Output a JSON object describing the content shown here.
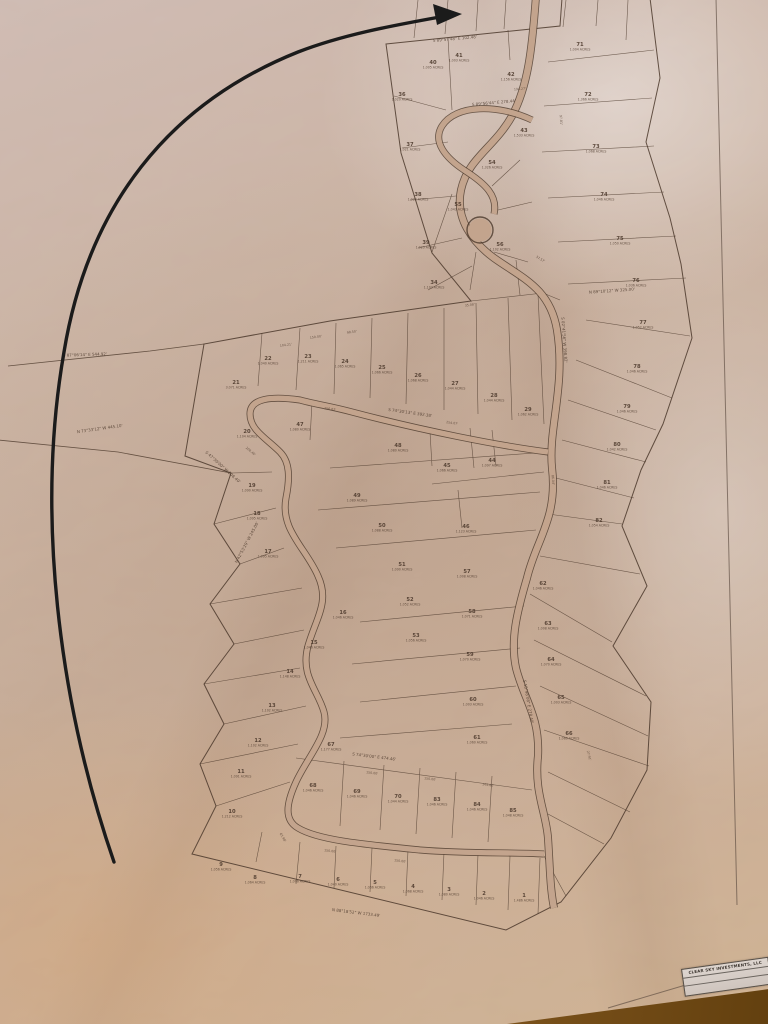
{
  "scene": {
    "description": "Photograph of a wrinkled paper subdivision plat map lying on a wooden table, with a long hand-drawn black arrow curving from the bottom left up to a lot near the top of the plat",
    "colors": {
      "paper": "#c3a48d",
      "ink": "#4b382b",
      "arrow": "#1b1b1b",
      "wood": "#8a5d22",
      "sheet_edge": "#5a4a3f",
      "title_block_bg": "#d6cdc6"
    }
  },
  "title_block": {
    "owner": "CLEAR SKY INVESTMENTS, LLC"
  },
  "map": {
    "boundary": "M386,44 L560,26 L562,-2 L650,-2 L660,78 L646,142 L670,218 L681,264 L692,338 L663,424 L641,470 L622,526 L647,586 L613,646 L651,702 L647,770 L611,838 L561,902 L506,930 L192,854 L216,806 L200,764 L224,724 L204,684 L234,644 L210,604 L240,564 L214,524 L231,473 L185,456 L204,344 L330,321 L471,301 L432,253 L401,153 Z",
    "tie_lines": "M204,344 L150,351 L8,366 M231,473 L118,452 L-2,440",
    "sheet_border": "M716,-2 L737,905 M608,1008 L770,960",
    "lot_lines": "M418,0 L414,38 M448,0 L445,34 M478,0 L476,31 M506,0 L504,29 M566,0 L563,27 M598,0 L596,26 M628,0 L626,40 M394,96 L446,110 M402,148 L448,142 M410,200 L456,196 M418,248 L462,238 M428,290 L472,266 M452,110 L448,38 M510,60 L508,30 M492,186 L520,160 M498,210 L532,202 M494,252 L528,262 M476,252 L470,290 M452,194 L432,252 M471,301 L543,293 M520,295 L516,260 M543,293 L560,300 M548,62 L654,50 M544,106 L652,98 M542,152 L654,146 M548,198 L664,192 M558,242 L676,236 M568,284 L686,278 M586,320 L690,336 M576,360 L672,398 M568,400 L656,430 M562,440 L646,462 M556,478 L634,498 M548,514 L622,524 M540,556 L640,574 M530,594 L612,642 M534,640 L646,696 M540,686 L648,736 M544,730 L649,766 M548,772 L630,812 M548,814 L604,844 M544,856 L566,896 M262,333 L258,386 M300,328 L296,390 M336,323 L334,394 M372,318 L370,398 M408,313 L406,404 M444,308 L444,410 M476,303 L478,414 M508,298 L512,420 M538,294 L544,424 M231,473 L272,472 M214,524 L276,508 M240,564 L284,548 M210,604 L302,588 M234,644 L304,630 M204,684 L300,668 M224,724 L306,706 M200,764 L298,744 M216,806 L290,782 M296,758 L532,790 M344,761 L340,826 M384,765 L380,830 M420,768 L416,834 M456,772 L452,838 M492,776 L488,842 M262,832 L256,862 M300,842 L296,884 M336,846 L334,888 M372,848 L370,892 M408,850 L406,896 M444,852 L442,900 M478,854 L476,905 M510,856 L508,910 M540,858 L538,914 M330,468 L548,452 M318,510 L540,492 M336,548 L536,530 M360,622 L524,606 M352,664 L520,648 M360,702 L516,686 M340,738 L512,724 M470,428 L474,468 M492,430 L496,466 M458,490 L462,528 M430,432 L432,466 M432,484 L544,472 M312,402 L310,440",
    "roads": [
      {
        "d": "M536,-4 C532,50 528,86 512,116 C494,148 468,158 461,190 C455,218 472,242 494,258 C522,278 550,288 557,330 C566,386 548,428 552,468 C558,518 536,540 527,578 C517,612 510,640 516,668 C524,700 540,716 538,756 C534,792 546,812 548,838 C550,868 550,888 554,908",
        "w": 8
      },
      {
        "d": "M548,452 C500,446 420,430 352,412 C330,406 314,404 300,400 C272,396 250,398 250,414 C250,430 266,438 280,452 C290,462 290,478 286,498 C280,530 306,548 318,576 C330,602 316,618 308,646 C300,676 318,690 324,712 C330,734 308,756 296,782 C286,804 284,820 298,828 C318,840 360,844 420,850 C470,854 510,852 544,854",
        "w": 7
      },
      {
        "d": "M532,120 C498,104 456,104 442,126 C432,142 446,158 464,170 C486,184 498,196 494,214",
        "w": 7
      }
    ],
    "culdesac": {
      "cx": 480,
      "cy": 230,
      "r": 13
    },
    "lots": [
      {
        "n": "40",
        "ac": "1.005 ACRES",
        "x": 433,
        "y": 64
      },
      {
        "n": "41",
        "ac": "1.003 ACRES",
        "x": 459,
        "y": 57
      },
      {
        "n": "42",
        "ac": "1.156 ACRES",
        "x": 511,
        "y": 76
      },
      {
        "n": "43",
        "ac": "1.533 ACRES",
        "x": 524,
        "y": 132
      },
      {
        "n": "36",
        "ac": "1.020 ACRES",
        "x": 402,
        "y": 96
      },
      {
        "n": "37",
        "ac": "1.021 ACRES",
        "x": 410,
        "y": 146
      },
      {
        "n": "38",
        "ac": "1.022 ACRES",
        "x": 418,
        "y": 196
      },
      {
        "n": "39",
        "ac": "1.023 ACRES",
        "x": 426,
        "y": 244
      },
      {
        "n": "34",
        "ac": "1.103 ACRES",
        "x": 434,
        "y": 284
      },
      {
        "n": "54",
        "ac": "1.326 ACRES",
        "x": 492,
        "y": 164
      },
      {
        "n": "55",
        "ac": "1.043 ACRES",
        "x": 458,
        "y": 206
      },
      {
        "n": "56",
        "ac": "1.102 ACRES",
        "x": 500,
        "y": 246
      },
      {
        "n": "71",
        "ac": "1.004 ACRES",
        "x": 580,
        "y": 46
      },
      {
        "n": "72",
        "ac": "1.366 ACRES",
        "x": 588,
        "y": 96
      },
      {
        "n": "73",
        "ac": "1.068 ACRES",
        "x": 596,
        "y": 148
      },
      {
        "n": "74",
        "ac": "1.046 ACRES",
        "x": 604,
        "y": 196
      },
      {
        "n": "75",
        "ac": "1.050 ACRES",
        "x": 620,
        "y": 240
      },
      {
        "n": "76",
        "ac": "1.036 ACRES",
        "x": 636,
        "y": 282
      },
      {
        "n": "77",
        "ac": "1.052 ACRES",
        "x": 643,
        "y": 324
      },
      {
        "n": "78",
        "ac": "1.046 ACRES",
        "x": 637,
        "y": 368
      },
      {
        "n": "79",
        "ac": "1.046 ACRES",
        "x": 627,
        "y": 408
      },
      {
        "n": "80",
        "ac": "1.042 ACRES",
        "x": 617,
        "y": 446
      },
      {
        "n": "81",
        "ac": "1.046 ACRES",
        "x": 607,
        "y": 484
      },
      {
        "n": "82",
        "ac": "1.054 ACRES",
        "x": 599,
        "y": 522
      },
      {
        "n": "21",
        "ac": "3.071 ACRES",
        "x": 236,
        "y": 384
      },
      {
        "n": "22",
        "ac": "1.040 ACRES",
        "x": 268,
        "y": 360
      },
      {
        "n": "23",
        "ac": "1.211 ACRES",
        "x": 308,
        "y": 358
      },
      {
        "n": "24",
        "ac": "1.065 ACRES",
        "x": 345,
        "y": 363
      },
      {
        "n": "25",
        "ac": "1.066 ACRES",
        "x": 382,
        "y": 369
      },
      {
        "n": "26",
        "ac": "1.068 ACRES",
        "x": 418,
        "y": 377
      },
      {
        "n": "27",
        "ac": "1.044 ACRES",
        "x": 455,
        "y": 385
      },
      {
        "n": "28",
        "ac": "1.044 ACRES",
        "x": 494,
        "y": 397
      },
      {
        "n": "29",
        "ac": "1.062 ACRES",
        "x": 528,
        "y": 411
      },
      {
        "n": "20",
        "ac": "1.104 ACRES",
        "x": 247,
        "y": 433
      },
      {
        "n": "19",
        "ac": "1.090 ACRES",
        "x": 252,
        "y": 487
      },
      {
        "n": "18",
        "ac": "1.095 ACRES",
        "x": 257,
        "y": 515
      },
      {
        "n": "17",
        "ac": "1.095 ACRES",
        "x": 268,
        "y": 553
      },
      {
        "n": "16",
        "ac": "1.046 ACRES",
        "x": 343,
        "y": 614
      },
      {
        "n": "15",
        "ac": "1.046 ACRES",
        "x": 314,
        "y": 644
      },
      {
        "n": "14",
        "ac": "1.148 ACRES",
        "x": 290,
        "y": 673
      },
      {
        "n": "13",
        "ac": "1.102 ACRES",
        "x": 272,
        "y": 707
      },
      {
        "n": "12",
        "ac": "1.102 ACRES",
        "x": 258,
        "y": 742
      },
      {
        "n": "11",
        "ac": "1.091 ACRES",
        "x": 241,
        "y": 773
      },
      {
        "n": "10",
        "ac": "1.212 ACRES",
        "x": 232,
        "y": 813
      },
      {
        "n": "47",
        "ac": "1.080 ACRES",
        "x": 300,
        "y": 426
      },
      {
        "n": "44",
        "ac": "1.097 ACRES",
        "x": 492,
        "y": 462
      },
      {
        "n": "45",
        "ac": "1.066 ACRES",
        "x": 447,
        "y": 467
      },
      {
        "n": "46",
        "ac": "1.123 ACRES",
        "x": 466,
        "y": 528
      },
      {
        "n": "48",
        "ac": "1.080 ACRES",
        "x": 398,
        "y": 447
      },
      {
        "n": "49",
        "ac": "1.089 ACRES",
        "x": 357,
        "y": 497
      },
      {
        "n": "50",
        "ac": "1.088 ACRES",
        "x": 382,
        "y": 527
      },
      {
        "n": "51",
        "ac": "1.090 ACRES",
        "x": 402,
        "y": 566
      },
      {
        "n": "52",
        "ac": "1.052 ACRES",
        "x": 410,
        "y": 601
      },
      {
        "n": "53",
        "ac": "1.056 ACRES",
        "x": 416,
        "y": 637
      },
      {
        "n": "57",
        "ac": "1.008 ACRES",
        "x": 467,
        "y": 573
      },
      {
        "n": "58",
        "ac": "1.071 ACRES",
        "x": 472,
        "y": 613
      },
      {
        "n": "59",
        "ac": "1.070 ACRES",
        "x": 470,
        "y": 656
      },
      {
        "n": "60",
        "ac": "1.003 ACRES",
        "x": 473,
        "y": 701
      },
      {
        "n": "61",
        "ac": "1.060 ACRES",
        "x": 477,
        "y": 739
      },
      {
        "n": "62",
        "ac": "1.046 ACRES",
        "x": 543,
        "y": 585
      },
      {
        "n": "63",
        "ac": "1.008 ACRES",
        "x": 548,
        "y": 625
      },
      {
        "n": "64",
        "ac": "1.070 ACRES",
        "x": 551,
        "y": 661
      },
      {
        "n": "65",
        "ac": "1.003 ACRES",
        "x": 561,
        "y": 699
      },
      {
        "n": "66",
        "ac": "1.060 ACRES",
        "x": 569,
        "y": 735
      },
      {
        "n": "67",
        "ac": "1.177 ACRES",
        "x": 331,
        "y": 746
      },
      {
        "n": "68",
        "ac": "1.046 ACRES",
        "x": 313,
        "y": 787
      },
      {
        "n": "69",
        "ac": "1.046 ACRES",
        "x": 357,
        "y": 793
      },
      {
        "n": "70",
        "ac": "1.044 ACRES",
        "x": 398,
        "y": 798
      },
      {
        "n": "83",
        "ac": "1.046 ACRES",
        "x": 437,
        "y": 801
      },
      {
        "n": "84",
        "ac": "1.046 ACRES",
        "x": 477,
        "y": 806
      },
      {
        "n": "85",
        "ac": "1.048 ACRES",
        "x": 513,
        "y": 812
      },
      {
        "n": "9",
        "ac": "1.056 ACRES",
        "x": 221,
        "y": 866
      },
      {
        "n": "8",
        "ac": "1.064 ACRES",
        "x": 255,
        "y": 879
      },
      {
        "n": "7",
        "ac": "1.066 ACRES",
        "x": 300,
        "y": 878
      },
      {
        "n": "6",
        "ac": "1.040 ACRES",
        "x": 338,
        "y": 881
      },
      {
        "n": "5",
        "ac": "1.066 ACRES",
        "x": 375,
        "y": 884
      },
      {
        "n": "4",
        "ac": "1.068 ACRES",
        "x": 413,
        "y": 888
      },
      {
        "n": "3",
        "ac": "1.080 ACRES",
        "x": 449,
        "y": 891
      },
      {
        "n": "2",
        "ac": "1.046 ACRES",
        "x": 484,
        "y": 895
      },
      {
        "n": "1",
        "ac": "1.486 ACRES",
        "x": 524,
        "y": 897
      }
    ],
    "bearings": [
      {
        "t": "S 87°06'14\" E  544.92'",
        "x": 85,
        "y": 356,
        "r": -2
      },
      {
        "t": "N 73°33'12\" W  445.10'",
        "x": 100,
        "y": 430,
        "r": -8
      },
      {
        "t": "S 89°57'48\" E  102.48'",
        "x": 455,
        "y": 40,
        "r": -5
      },
      {
        "t": "S 89°56'44\" E  278.44'",
        "x": 494,
        "y": 104,
        "r": -5
      },
      {
        "t": "S 74°30'13\" E  392.38'",
        "x": 410,
        "y": 414,
        "r": 8
      },
      {
        "t": "S 74°30'00\" E  474.46'",
        "x": 374,
        "y": 758,
        "r": 7
      },
      {
        "t": "N 88°18'52\" W  1733.49'",
        "x": 356,
        "y": 914,
        "r": 7
      },
      {
        "t": "N 42°53'29\" W  245.00'",
        "x": 248,
        "y": 543,
        "r": -62
      },
      {
        "t": "S 47°30'00\" W  208.40'",
        "x": 222,
        "y": 468,
        "r": 42
      },
      {
        "t": "S 02°41'56\" W  398.82'",
        "x": 563,
        "y": 340,
        "r": 86
      },
      {
        "t": "S 15°48'08\" E  278.40'",
        "x": 527,
        "y": 702,
        "r": 80
      },
      {
        "t": "N 89°10'12\" W  325.00'",
        "x": 612,
        "y": 292,
        "r": -4
      }
    ],
    "dims": [
      {
        "t": "150.00'",
        "x": 316,
        "y": 338,
        "r": -8
      },
      {
        "t": "104.21'",
        "x": 286,
        "y": 346,
        "r": -8
      },
      {
        "t": "98.50'",
        "x": 352,
        "y": 333,
        "r": -8
      },
      {
        "t": "35.08'",
        "x": 470,
        "y": 306,
        "r": -8
      },
      {
        "t": "194.27'",
        "x": 520,
        "y": 90,
        "r": -4
      },
      {
        "t": "208.40'",
        "x": 250,
        "y": 452,
        "r": 40
      },
      {
        "t": "156.62'",
        "x": 330,
        "y": 410,
        "r": 8
      },
      {
        "t": "254.07'",
        "x": 452,
        "y": 424,
        "r": 8
      },
      {
        "t": "150.00'",
        "x": 372,
        "y": 774,
        "r": 7
      },
      {
        "t": "150.00'",
        "x": 430,
        "y": 780,
        "r": 7
      },
      {
        "t": "144.80'",
        "x": 488,
        "y": 786,
        "r": 7
      },
      {
        "t": "150.00'",
        "x": 330,
        "y": 852,
        "r": 7
      },
      {
        "t": "150.00'",
        "x": 400,
        "y": 862,
        "r": 7
      },
      {
        "t": "63.98'",
        "x": 282,
        "y": 838,
        "r": 60
      },
      {
        "t": "97.81'",
        "x": 560,
        "y": 120,
        "r": 85
      },
      {
        "t": "86.04'",
        "x": 552,
        "y": 480,
        "r": 85
      },
      {
        "t": "27.91'",
        "x": 588,
        "y": 756,
        "r": 75
      },
      {
        "t": "37.57'",
        "x": 540,
        "y": 260,
        "r": 30
      }
    ]
  },
  "annotation": {
    "arrow_path": "M114,862 C58,700 36,512 64,352 C88,206 168,104 298,52 C342,35 390,26 440,17",
    "arrow_head": "462,14 433,4 437,25"
  }
}
